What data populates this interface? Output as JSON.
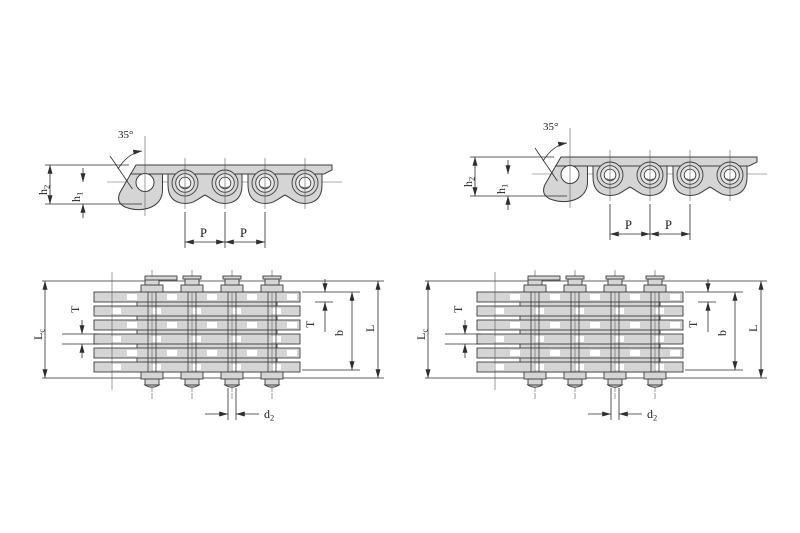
{
  "diagram": {
    "labels": {
      "angle": "35°",
      "h2_main": "h",
      "h2_sub": "2",
      "h1_main": "h",
      "h1_sub": "1",
      "pitch": "P",
      "lc_main": "L",
      "lc_sub": "c",
      "thickness": "T",
      "width_b": "b",
      "length_l": "L",
      "d2_main": "d",
      "d2_sub": "2"
    },
    "colors": {
      "plate_fill": "#d5d5d5",
      "outline": "#3d3d3d",
      "dimension_line": "#2e2e2e",
      "background": "#ffffff",
      "text": "#1c1c1c"
    }
  }
}
